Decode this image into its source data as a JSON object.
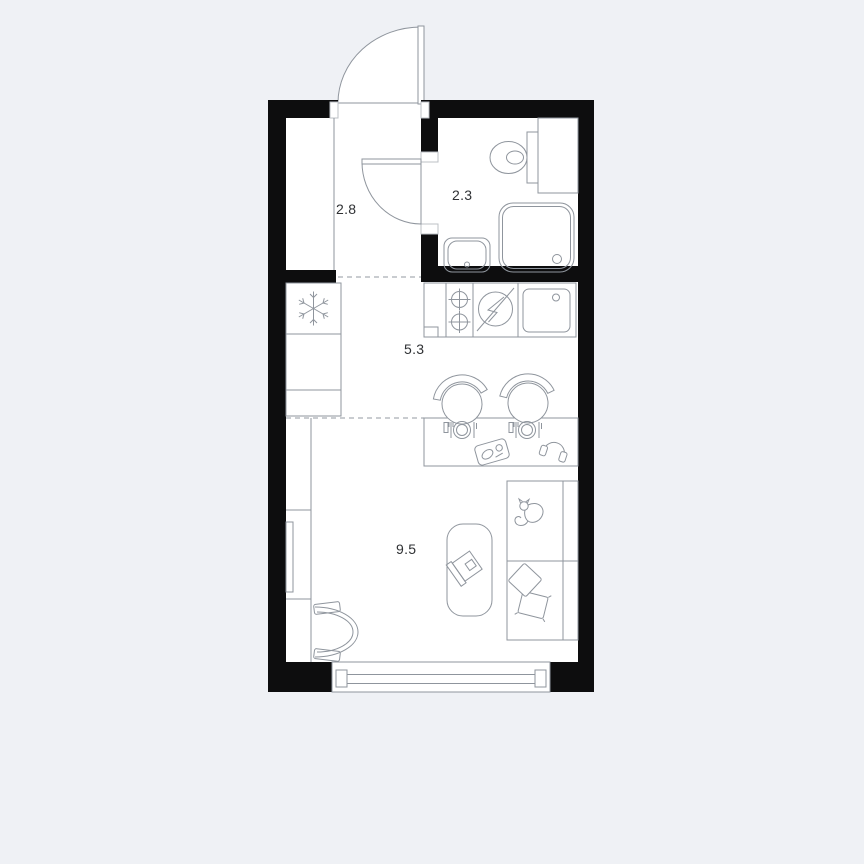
{
  "plan": {
    "type": "studio-apartment-floor-plan",
    "rooms": [
      {
        "name": "hallway",
        "area": "2.8"
      },
      {
        "name": "bathroom",
        "area": "2.3"
      },
      {
        "name": "kitchen",
        "area": "5.3"
      },
      {
        "name": "living-room",
        "area": "9.5"
      }
    ],
    "colors": {
      "background": "#eff1f5",
      "walls": "#0d0d0e",
      "furniture_lines": "#8f959d",
      "floor": "#ffffff",
      "label_text": "#2f3134"
    },
    "icons": {
      "entrance-door": "quarter-circle-swing-arc",
      "bathroom-door": "quarter-circle-swing-arc",
      "toilet": "oval-bowl-with-cistern",
      "shower-tray": "rounded-square-with-drain",
      "washbasin": "rounded-rect-with-drain",
      "fridge": "snowflake",
      "cooktop": "two-crossed-burners",
      "electric-panel": "circle-with-lightning-bolt",
      "kitchen-sink": "rounded-square-with-tap-hole",
      "bar-stool": "circle-with-backrest-band",
      "place-setting": "plate-with-cutlery",
      "serving-tray": "rotated-rounded-rect",
      "headphones": "arc-with-ear-cups",
      "wardrobe": "compartment-column",
      "tv": "thin-vertical-slab",
      "armchair": "d-shaped-double-arc",
      "ottoman": "rounded-rect",
      "laptop": "rotated-open-laptop",
      "bed": "rect-with-divider",
      "cat": "curled-cat-outline",
      "pillows": "two-rotated-squares",
      "window": "double-glazing-band"
    }
  }
}
